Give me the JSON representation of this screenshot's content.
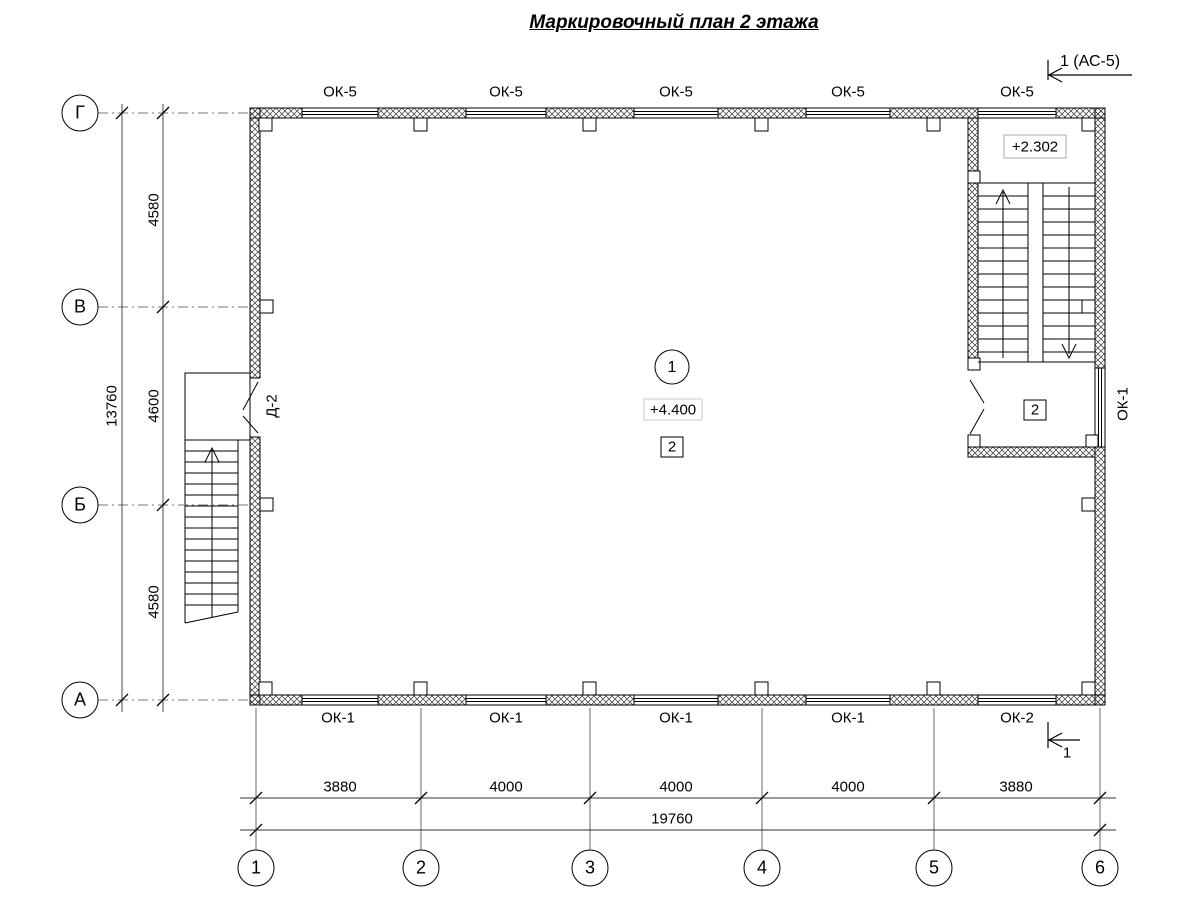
{
  "title": "Маркировочный план 2 этажа",
  "section_marks": {
    "top": "1 (АС-5)",
    "bottom": "1"
  },
  "axes": {
    "rows": [
      "Г",
      "В",
      "Б",
      "А"
    ],
    "cols": [
      "1",
      "2",
      "3",
      "4",
      "5",
      "6"
    ]
  },
  "dimensions": {
    "left_segments": [
      "4580",
      "4600",
      "4580"
    ],
    "left_total": "13760",
    "bottom_segments": [
      "3880",
      "4000",
      "4000",
      "4000",
      "3880"
    ],
    "bottom_total": "19760"
  },
  "windows": {
    "top": [
      "ОК-5",
      "ОК-5",
      "ОК-5",
      "ОК-5",
      "ОК-5"
    ],
    "bottom": [
      "ОК-1",
      "ОК-1",
      "ОК-1",
      "ОК-1",
      "ОК-2"
    ],
    "right": "ОК-1"
  },
  "door": {
    "label": "Д-2"
  },
  "rooms": {
    "main": {
      "number": "1",
      "level": "+4.400",
      "finish_type": "2"
    },
    "stair_room": {
      "finish_type": "2"
    },
    "stair_landing_level": "+2.302"
  }
}
